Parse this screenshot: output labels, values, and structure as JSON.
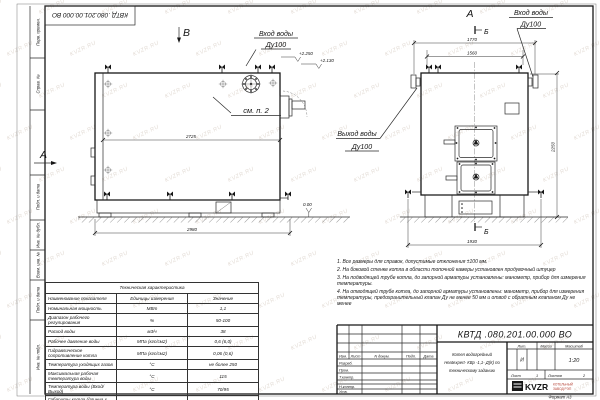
{
  "page": {
    "format_note": "Формат А3"
  },
  "watermark": {
    "text": "KVZR.RU"
  },
  "stamp": {
    "doc_number": "КВТД .080.201.00.000 ВО"
  },
  "margin_labels": [
    "Перв. примен.",
    "Справ. №",
    "Подп. и дата",
    "Инв. № дубл.",
    "Взам. инв. №",
    "Подп. и дата",
    "Инв. № подл."
  ],
  "views": {
    "side": {
      "view_arrow": "В",
      "section_arrow": "А",
      "inlet_line1": "Вход воды",
      "inlet_line2": "Ду100",
      "outlet_line1": "Выход воды",
      "outlet_line2": "Ду100",
      "see_note_ref": "см. п. 2",
      "elev_1": "+2.250",
      "elev_2": "+2.130",
      "elev_zero": "0.00",
      "dim_inner_length": "2725",
      "dim_overall_length": "2980"
    },
    "front": {
      "view_label": "А",
      "section_label": "Б",
      "inlet_line1": "Вход воды",
      "inlet_line2": "Ду100",
      "dim_overall_width": "1770",
      "dim_fitting_span": "1560",
      "dim_base_width": "1930",
      "dim_height": "2250"
    }
  },
  "notes": [
    "1. Все размеры для справок, допустимые отклонения ±100 мм.",
    "2. На боковой стенке котла в области топочной камеры установлен продувочный штуцер",
    "3. На подводящей трубе котла, до запорной арматуры установлены: манометр, прибор для измерения температуры.",
    "4. На отводящей трубе котла, до запорной арматуры установлены: манометр, прибор для измерения температуры, предохранительный клапан Ду не менее 50 мм и отвод с обратным клапаном Ду не менее"
  ],
  "tech_table": {
    "title": "Техническая характеристика",
    "headers": [
      "Наименование показателя",
      "Единицы измерения",
      "Значение"
    ],
    "rows": [
      [
        "Номинальная мощность",
        "МВт",
        "1,1"
      ],
      [
        "Диапазон рабочего регулирования",
        "%",
        "50-100"
      ],
      [
        "Расход воды",
        "м3/ч",
        "38"
      ],
      [
        "Рабочее давление воды",
        "МПа (кгс/см2)",
        "0,6 (6,0)"
      ],
      [
        "Гидравлическое сопротивление котла",
        "МПа (кгс/см2)",
        "0,06 (0,6)"
      ],
      [
        "Температура уходящих газов",
        "°С",
        "не более 250"
      ],
      [
        "Максимальная рабочая температура воды",
        "°С",
        "115"
      ],
      [
        "Температура воды (Вход/Выход)",
        "°С",
        "70/95"
      ],
      [
        "Габариты котла (длинна х ширина х высота)",
        "мм",
        "2980х1930х2250"
      ]
    ]
  },
  "titleblock": {
    "doc_number": "КВТД .080.201.00.000  ВО",
    "product_line1": "Котел водогрейный",
    "product_line2": "Heatexpert- КВр -1,1- Д(К) по",
    "product_line3": "техническому заданию",
    "col_izm": "Изм.",
    "col_list": "Лист",
    "col_doc": "N докум.",
    "col_podp": "Подп.",
    "col_data": "Дата",
    "row_razrab": "Разраб.",
    "row_prov": "Пров.",
    "row_tkontr": "Т.контр.",
    "row_nkontr": "Н.контр.",
    "row_utv": "Утв.",
    "lit_label": "Лит.",
    "lit_value": "И",
    "mass_label": "Масса",
    "scale_label": "Масштаб",
    "scale_value": "1:20",
    "sheet_label": "Лист",
    "sheet_value": "1",
    "sheets_label": "Листов",
    "sheets_value": "2",
    "logo_text": "KVZR",
    "logo_sub1": "КОТЕЛЬНЫЙ",
    "logo_sub2": "ЗАВОД РЭП"
  }
}
